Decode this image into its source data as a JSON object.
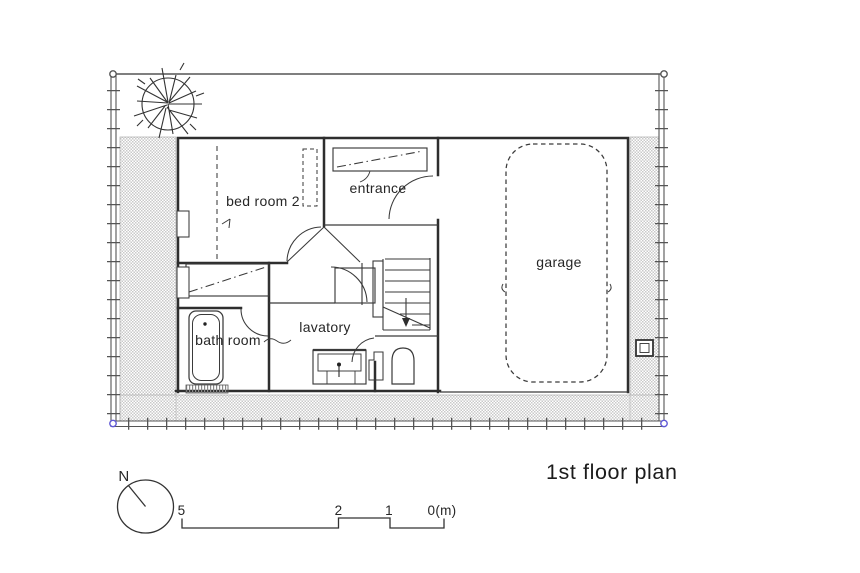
{
  "title": "1st floor plan",
  "rooms": {
    "bedroom2": "bed room 2",
    "entrance": "entrance",
    "garage": "garage",
    "lavatory": "lavatory",
    "bathroom": "bath room"
  },
  "compass": {
    "north_label": "N"
  },
  "scale_bar": {
    "tick_labels": [
      "5",
      "2",
      "1",
      "0(m)"
    ],
    "unit": "m"
  },
  "colors": {
    "wall_line": "#2e2e2e",
    "thin_line": "#3a3a3a",
    "hatch_gray": "#c9c9c9",
    "corner_marker_top": "#555555",
    "corner_marker_bottom": "#6059d6",
    "background": "#ffffff"
  },
  "icons": {
    "tree": "tree-icon",
    "north_arrow": "north-arrow-icon",
    "car_outline": "car-outline-icon",
    "bathtub": "bathtub-icon",
    "toilet": "toilet-icon",
    "sink_vanity": "sink-icon",
    "stairs": "stairs-icon",
    "utility_meter": "meter-icon"
  }
}
